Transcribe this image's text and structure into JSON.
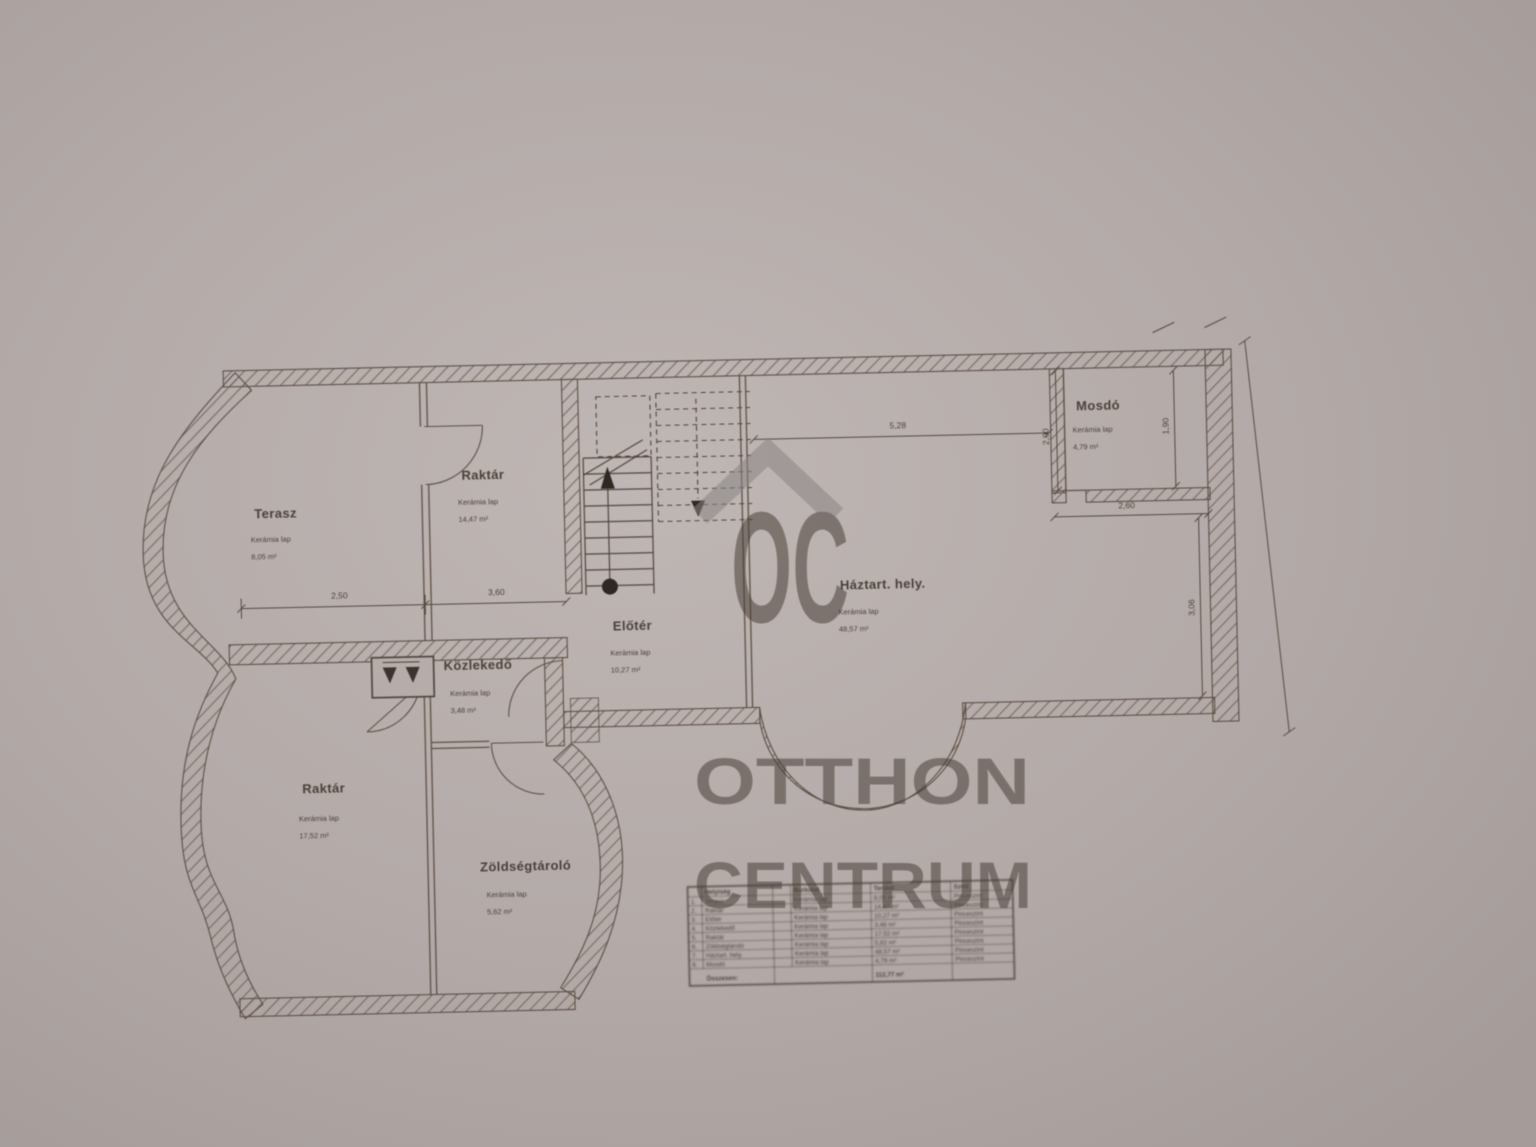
{
  "watermark": {
    "logo_letters": "OC",
    "line1": "OTTHON",
    "line2": "CENTRUM"
  },
  "rooms": {
    "terasz": {
      "name": "Terasz",
      "material": "Kerámia lap",
      "area": "8,05 m²"
    },
    "raktar_felso": {
      "name": "Raktár",
      "material": "Kerámia lap",
      "area": "14,47 m²"
    },
    "mosdo": {
      "name": "Mosdó",
      "material": "Kerámia lap",
      "area": "4,79 m²"
    },
    "haztartasi": {
      "name": "Háztart. hely.",
      "material": "Kerámia lap",
      "area": "48,57 m²"
    },
    "eloter": {
      "name": "Előtér",
      "material": "Kerámia lap",
      "area": "10,27 m²"
    },
    "kozlekedo": {
      "name": "Közlekedő",
      "material": "Kerámia lap",
      "area": "3,48 m²"
    },
    "raktar_also": {
      "name": "Raktár",
      "material": "Kerámia lap",
      "area": "17,52 m²"
    },
    "zoldseg": {
      "name": "Zöldségtároló",
      "material": "Kerámia lap",
      "area": "5,62 m²"
    }
  },
  "dimensions": {
    "terasz_width": "2,50",
    "raktar_width": "3,60",
    "haztart_width": "5,28",
    "mosdo_width": "2,60",
    "mosdo_depth": "1,90",
    "mosdo_wall": "2,00",
    "haztart_depth": "3,06"
  },
  "schedule": {
    "headers": {
      "room": "Helyiség",
      "floor": "Burkolat",
      "area": "Terület",
      "level": "Szint"
    },
    "rows": [
      {
        "no": "1.",
        "name": "Terasz",
        "floor": "Kerámia lap",
        "area": "8,05 m²",
        "level": "Pinceszint"
      },
      {
        "no": "2.",
        "name": "Raktár",
        "floor": "Kerámia lap",
        "area": "14,47 m²",
        "level": "Pinceszint"
      },
      {
        "no": "3.",
        "name": "Előtér",
        "floor": "Kerámia lap",
        "area": "10,27 m²",
        "level": "Pinceszint"
      },
      {
        "no": "4.",
        "name": "Közlekedő",
        "floor": "Kerámia lap",
        "area": "3,48 m²",
        "level": "Pinceszint"
      },
      {
        "no": "5.",
        "name": "Raktár",
        "floor": "Kerámia lap",
        "area": "17,52 m²",
        "level": "Pinceszint"
      },
      {
        "no": "6.",
        "name": "Zöldségtároló",
        "floor": "Kerámia lap",
        "area": "5,62 m²",
        "level": "Pinceszint"
      },
      {
        "no": "7.",
        "name": "Háztart. hely.",
        "floor": "Kerámia lap",
        "area": "48,57 m²",
        "level": "Pinceszint"
      },
      {
        "no": "8.",
        "name": "Mosdó",
        "floor": "Kerámia lap",
        "area": "4,79 m²",
        "level": "Pinceszint"
      }
    ],
    "total_label": "Összesen:",
    "total_area": "112,77 m²"
  }
}
